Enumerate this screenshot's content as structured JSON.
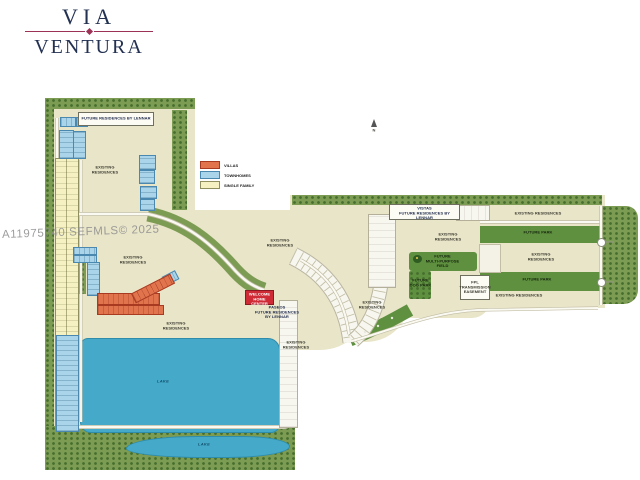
{
  "watermark": "A11975740 SEFMLS© 2025",
  "logo": {
    "line1": "VIA",
    "line2": "VENTURA"
  },
  "compass": {
    "north_label": "N"
  },
  "legend": {
    "items": [
      {
        "label": "VILLAS",
        "color": "#e1744d"
      },
      {
        "label": "TOWNHOMES",
        "color": "#a9d4e9"
      },
      {
        "label": "SINGLE FAMILY",
        "color": "#f5f1c3"
      }
    ]
  },
  "map": {
    "parcels": {
      "future_residences_north": "FUTURE RESIDENCES BY LENNAR",
      "welcome_home_center": "WELCOME\nHOME CENTER",
      "paseos": "PASEOS\nFUTURE RESIDENCES\nBY LENNAR",
      "vistas": "VISTAS\nFUTURE RESIDENCES BY LENNAR",
      "existing_residences": "EXISTING\nRESIDENCES",
      "existing_residences_one_line": "EXISTING RESIDENCES",
      "future_park": "FUTURE PARK",
      "multi_purpose_field": "FUTURE\nMULTI-PURPOSE\nFIELD",
      "dog_park": "FUTURE\nDOG PARK",
      "fpl_easement": "FPL\nTRANSMISSION\nEASEMENT",
      "lake": "LAKE"
    },
    "colors": {
      "land": "#e9e5c9",
      "green": "#7d9c53",
      "park_green": "#5f9040",
      "lake": "#45a9c9",
      "villas": "#e1744d",
      "townhomes": "#a9d4e9",
      "single_family": "#f5f1c3",
      "welcome_center_red": "#cf2b36",
      "logo_navy": "#233152",
      "logo_maroon": "#9c3256"
    }
  }
}
